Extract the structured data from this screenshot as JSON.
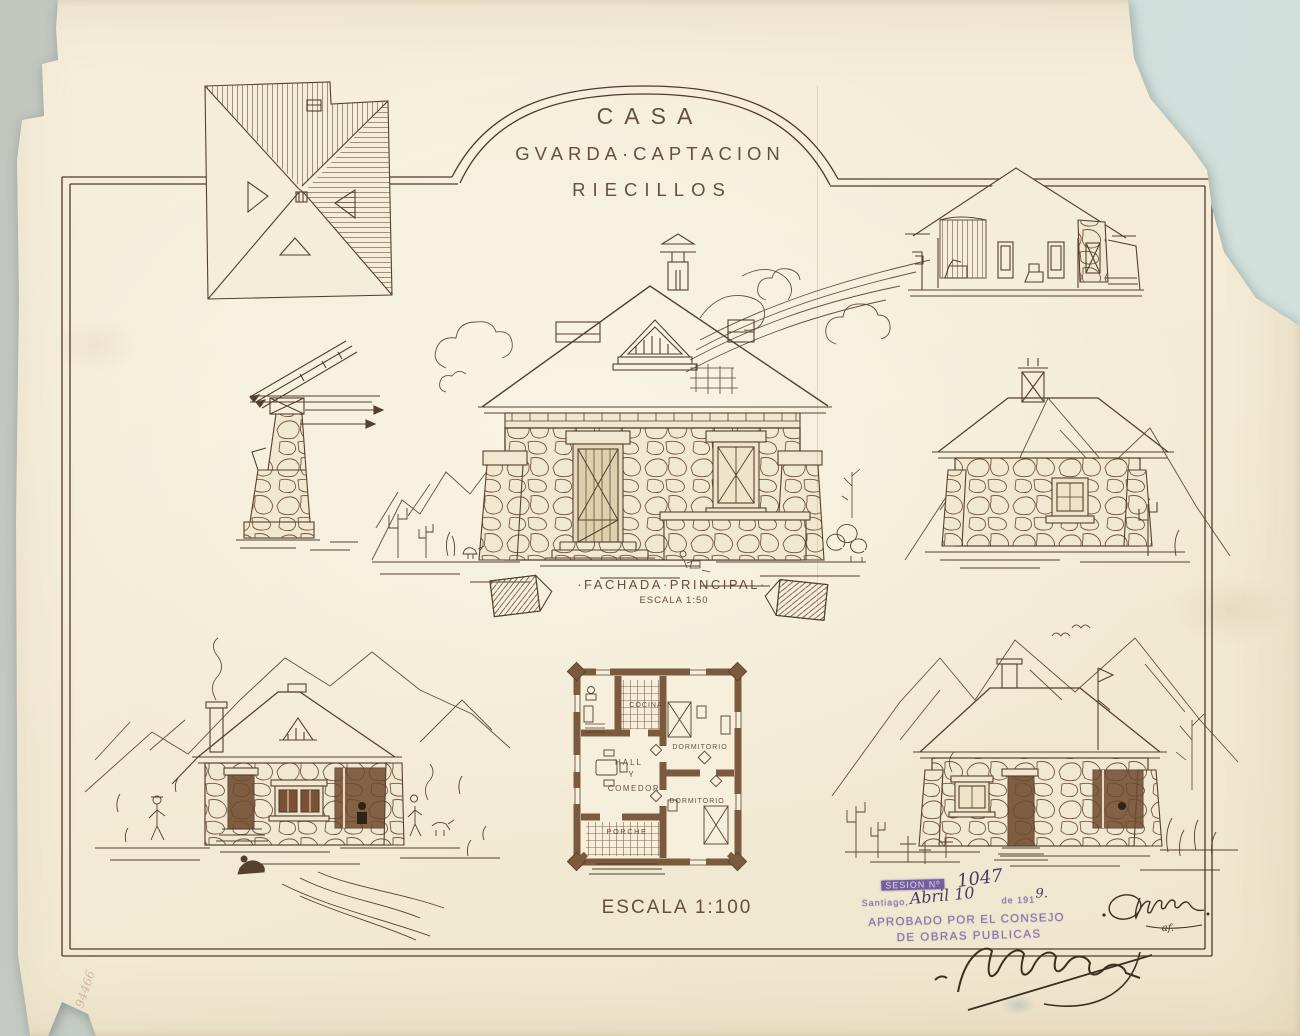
{
  "sheet": {
    "title_lines": [
      "CASA",
      "GVARDA·CAPTACION",
      "RIECILLOS"
    ],
    "facade_caption": "·FACHADA·PRINCIPAL·",
    "facade_scale": "ESCALA 1:50",
    "plan_scale": "ESCALA 1:100",
    "plan_rooms": {
      "kitchen": "COCINA",
      "hall": [
        "HALL",
        "Y",
        "COMEDOR"
      ],
      "bedroom_top": "DORMITORIO",
      "bedroom_bottom": "DORMITORIO",
      "porch": "PORCHE"
    },
    "stamp": {
      "session_label": "SESION Nº",
      "session_number": "1047",
      "city": "Santiago,",
      "date_handwritten": "Abril 10",
      "year_printed": "de 191",
      "year_handwritten": "9.",
      "approval_line1": "APROBADO POR EL CONSEJO",
      "approval_line2": "DE OBRAS PUBLICAS"
    },
    "signature_note": "af.",
    "margin_number": "94466",
    "colors": {
      "ink": "#54402c",
      "paper": "#f4edda",
      "stamp": "#8673ae",
      "background": "#cfdeda"
    }
  }
}
